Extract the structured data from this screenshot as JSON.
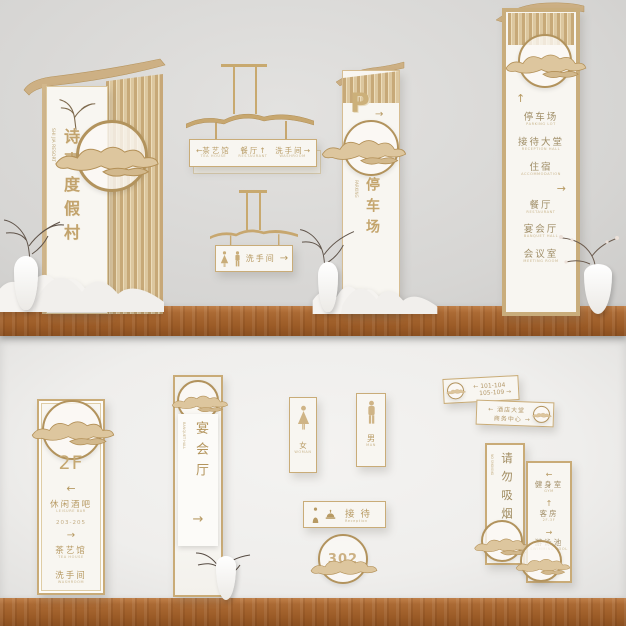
{
  "palette": {
    "gold": "#b79a63",
    "wood": "#a96832",
    "board": "#f8f6f1",
    "wall_top": "#d8d7d5",
    "wall_bottom": "#efeeec"
  },
  "main_totem": {
    "name_vertical": "诗嘉度假村",
    "name_latin": "SHI JIA RESORT"
  },
  "hanging_sign_1": {
    "items": [
      {
        "pre": "←",
        "label": "茶艺馆",
        "sub": "TEA HOUSE",
        "post": ""
      },
      {
        "pre": "",
        "label": "餐厅",
        "sub": "RESTAURANT",
        "post": "↑"
      },
      {
        "pre": "",
        "label": "洗手间",
        "sub": "WASHROOM",
        "post": "→"
      }
    ]
  },
  "hanging_sign_2": {
    "label": "洗手间",
    "arrow": "→"
  },
  "parking_totem": {
    "symbol": "P",
    "arrow": "→",
    "label_vertical": "停车场",
    "label_latin": "PARKING"
  },
  "directory_totem": {
    "rows": [
      {
        "text": "↑",
        "sub": ""
      },
      {
        "text": "停车场",
        "sub": "PARKING LOT"
      },
      {
        "text": "接待大堂",
        "sub": "RECEPTION HALL"
      },
      {
        "text": "住宿",
        "sub": "ACCOMMODATION"
      },
      {
        "text": "→",
        "sub": ""
      },
      {
        "text": "餐厅",
        "sub": "RESTAURANT"
      },
      {
        "text": "宴会厅",
        "sub": "BANQUET HALL"
      },
      {
        "text": "会议室",
        "sub": "MEETING ROOM"
      }
    ]
  },
  "floor_sign": {
    "floor": "2F",
    "arrow1": "←",
    "dest1": "休闲酒吧",
    "dest1_sub": "LEISURE BAR",
    "range": "203-205",
    "arrow2": "→",
    "dest2": "茶艺馆",
    "dest2_sub": "TEA HOUSE",
    "dest3": "洗手间",
    "dest3_sub": "WASHROOM"
  },
  "banquet_sign": {
    "label_vertical": "宴会厅",
    "label_latin": "BANQUET HALL",
    "arrow": "→"
  },
  "toilet_female": {
    "label": "女",
    "sub": "WOMAN"
  },
  "toilet_male": {
    "label": "男",
    "sub": "MAN"
  },
  "reception_sign": {
    "label": "接待",
    "sub": "Reception"
  },
  "room_number_sign": {
    "number": "302"
  },
  "room_range_sign": {
    "line1_pre": "←",
    "line1": "101-104",
    "line2": "105-109",
    "line2_post": "→"
  },
  "lobby_sign": {
    "line1_pre": "←",
    "line1": "酒店大堂",
    "line2": "商务中心",
    "line2_post": "→"
  },
  "no_smoking_sign": {
    "label_vertical": "请勿吸烟",
    "label_latin": "NO SMOKING"
  },
  "mini_directory": {
    "rows": [
      {
        "arrow": "←",
        "text": "健身室",
        "sub": "GYM"
      },
      {
        "arrow": "↑",
        "text": "客房",
        "sub": "2F-3F"
      },
      {
        "arrow": "→",
        "text": "游泳池",
        "sub": "SWIMMING POOL"
      }
    ]
  }
}
